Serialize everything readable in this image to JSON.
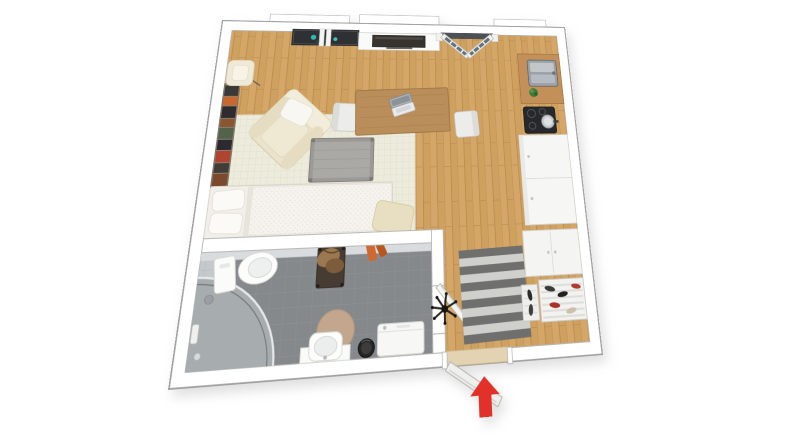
{
  "scene": {
    "type": "3d-floor-plan",
    "description": "studio-apartment-top-down-view",
    "background": "#ffffff"
  },
  "palette": {
    "wall": "#ffffff",
    "wall_outline": "#9f9f9f",
    "inner_wall_outline": "#b5b5b2",
    "wood_floor": "#cfa161",
    "wood_seam": "#b9894e",
    "bath_floor": "#85898c",
    "bath_wall_tile": "#c5c9cc",
    "rug_base": "#edebdc",
    "rug_grid": "#dfdcc7",
    "round_rug": "#c2a68e",
    "doormat_dark": "#6f6f6d",
    "doormat_light": "#cfcfcc",
    "window_sill": "#2e3033",
    "glass": "#667076",
    "tv_screen": "#37332f",
    "counter_wood": "#c29058",
    "cooktop": "#26282b",
    "cabinet_white": "#f6f6f4",
    "accent_teal": "#2fb8ad",
    "coat_orange": "#cd6a30",
    "arrow_red": "#e23128",
    "threshold": "#e4d3b2"
  },
  "rooms": [
    {
      "name": "living-room",
      "floor": "wood",
      "items": [
        "window",
        "floor-lamp",
        "bookshelf",
        "armchair",
        "area-rug",
        "coffee-table",
        "bed",
        "ottoman",
        "dining-table",
        "laptop",
        "dining-chair-left",
        "dining-chair-right",
        "tv-unit",
        "balcony-doors"
      ]
    },
    {
      "name": "kitchen",
      "floor": "wood",
      "items": [
        "counter",
        "sink",
        "plant",
        "cooktop",
        "pot",
        "tall-cabinet"
      ]
    },
    {
      "name": "bathroom",
      "floor": "gray-tile",
      "items": [
        "toilet",
        "toilet-brush",
        "valet-stand",
        "hanging-towels",
        "shower",
        "round-rug",
        "washbasin",
        "trash-bin",
        "washing-machine",
        "bathroom-door"
      ]
    },
    {
      "name": "entry-hall",
      "floor": "wood",
      "items": [
        "doormat",
        "coat-stand",
        "wardrobe",
        "shoe-rack",
        "shoe-rack-small",
        "entrance-door"
      ]
    }
  ],
  "entrance": {
    "indicator": "red-arrow-up",
    "meaning": "apartment-entrance"
  }
}
